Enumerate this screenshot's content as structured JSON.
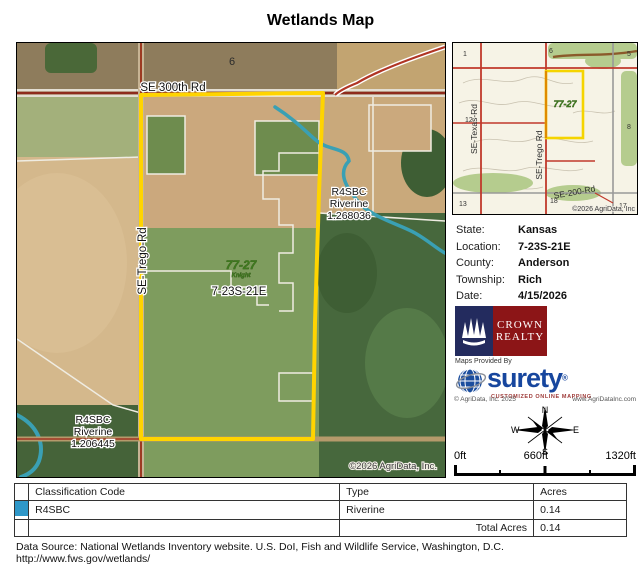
{
  "title": "Wetlands Map",
  "main_map": {
    "section_number": "6",
    "road_top": "SE 300th Rd",
    "road_left": "SE-Trego-Rd",
    "township_label": "7-23S-21E",
    "watermark_line1": "77-27",
    "watermark_line2": "Knight",
    "wetland_right": {
      "code": "R4SBC",
      "type": "Riverine",
      "id": "1.268036"
    },
    "wetland_bottom_left": {
      "code": "R4SBC",
      "type": "Riverine",
      "id": "1.206445"
    },
    "copyright": "©2026 AgriData, Inc."
  },
  "inset_map": {
    "numbers": {
      "n1": "1",
      "n6": "6",
      "n5": "5",
      "n12": "12",
      "n8": "8",
      "n13": "13",
      "n18": "18",
      "n17": "17"
    },
    "road_texas": "SE-Texas-Rd",
    "road_trego": "SE-Trego Rd",
    "road_200": "SE-200-Rd",
    "watermark": "77-27",
    "copyright": "©2026 AgriData, Inc"
  },
  "info": {
    "rows": [
      {
        "label": "State:",
        "value": "Kansas"
      },
      {
        "label": "Location:",
        "value": "7-23S-21E"
      },
      {
        "label": "County:",
        "value": "Anderson"
      },
      {
        "label": "Township:",
        "value": "Rich"
      },
      {
        "label": "Date:",
        "value": "4/15/2026"
      }
    ]
  },
  "logos": {
    "crown_line1": "CROWN",
    "crown_line2": "REALTY",
    "maps_provided_by": "Maps Provided By",
    "surety_name": "surety",
    "surety_registered": "®",
    "surety_tagline": "CUSTOMIZED ONLINE MAPPING",
    "agridata_copyright": "© AgriData, Inc. 2025",
    "agridata_url": "www.AgriDataInc.com"
  },
  "compass": {
    "n": "N",
    "s": "S",
    "e": "E",
    "w": "W"
  },
  "scale": {
    "labels": [
      "0ft",
      "660ft",
      "1320ft"
    ]
  },
  "table": {
    "headers": [
      "Classification Code",
      "Type",
      "Acres"
    ],
    "rows": [
      {
        "swatch_color": "#2E97C8",
        "code": "R4SBC",
        "type": "Riverine",
        "acres": "0.14"
      }
    ],
    "total_label": "Total Acres",
    "total_value": "0.14"
  },
  "footer": "Data Source: National Wetlands Inventory website. U.S. DoI, Fish and Wildlife Service, Washington, D.C. http://www.fws.gov/wetlands/",
  "colors": {
    "boundary_yellow": "#FFD400",
    "stream_blue": "#3AA0B4",
    "road_red": "#9C3A22",
    "swatch_blue": "#2E97C8"
  }
}
